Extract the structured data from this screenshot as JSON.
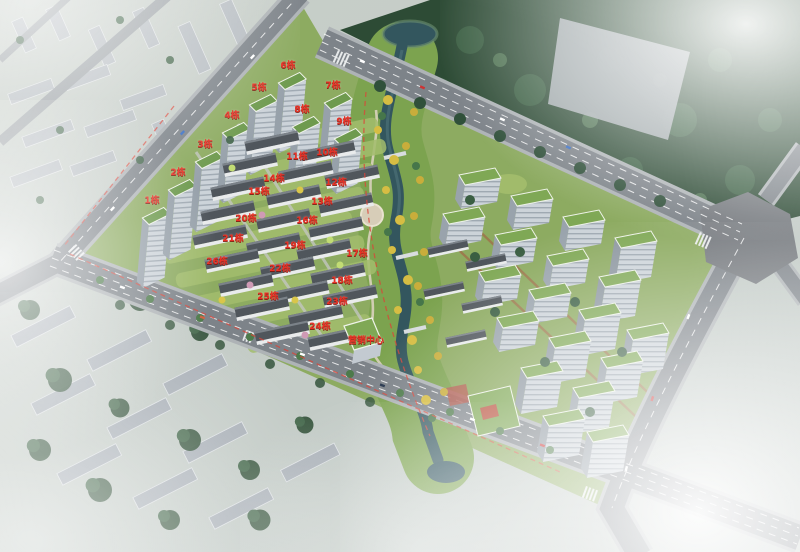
{
  "scene": {
    "kind": "aerial-masterplan-rendering",
    "marketing_center_label": "营销中心"
  },
  "labels": {
    "buildings": [
      {
        "id": "1",
        "text": "1栋",
        "x": 152,
        "y": 200,
        "kind": "tower"
      },
      {
        "id": "2",
        "text": "2栋",
        "x": 178,
        "y": 172,
        "kind": "tower"
      },
      {
        "id": "3",
        "text": "3栋",
        "x": 205,
        "y": 144,
        "kind": "tower"
      },
      {
        "id": "4",
        "text": "4栋",
        "x": 232,
        "y": 115,
        "kind": "tower"
      },
      {
        "id": "5",
        "text": "5栋",
        "x": 259,
        "y": 87,
        "kind": "tower"
      },
      {
        "id": "6",
        "text": "6栋",
        "x": 288,
        "y": 65,
        "kind": "tower"
      },
      {
        "id": "7",
        "text": "7栋",
        "x": 333,
        "y": 85,
        "kind": "tower"
      },
      {
        "id": "8",
        "text": "8栋",
        "x": 302,
        "y": 109,
        "kind": "tower"
      },
      {
        "id": "9",
        "text": "9栋",
        "x": 344,
        "y": 121,
        "kind": "tower"
      },
      {
        "id": "10",
        "text": "10栋",
        "x": 327,
        "y": 152,
        "kind": "villa"
      },
      {
        "id": "11",
        "text": "11栋",
        "x": 297,
        "y": 156,
        "kind": "villa"
      },
      {
        "id": "12",
        "text": "12栋",
        "x": 336,
        "y": 182,
        "kind": "villa"
      },
      {
        "id": "13",
        "text": "13栋",
        "x": 322,
        "y": 201,
        "kind": "villa"
      },
      {
        "id": "14",
        "text": "14栋",
        "x": 274,
        "y": 178,
        "kind": "villa"
      },
      {
        "id": "15",
        "text": "15栋",
        "x": 259,
        "y": 191,
        "kind": "villa"
      },
      {
        "id": "16",
        "text": "16栋",
        "x": 307,
        "y": 220,
        "kind": "villa"
      },
      {
        "id": "17",
        "text": "17栋",
        "x": 357,
        "y": 253,
        "kind": "villa"
      },
      {
        "id": "18",
        "text": "18栋",
        "x": 342,
        "y": 280,
        "kind": "villa"
      },
      {
        "id": "19",
        "text": "19栋",
        "x": 295,
        "y": 245,
        "kind": "villa"
      },
      {
        "id": "20",
        "text": "20栋",
        "x": 246,
        "y": 218,
        "kind": "villa"
      },
      {
        "id": "21",
        "text": "21栋",
        "x": 233,
        "y": 238,
        "kind": "villa"
      },
      {
        "id": "22",
        "text": "22栋",
        "x": 280,
        "y": 268,
        "kind": "villa"
      },
      {
        "id": "23",
        "text": "23栋",
        "x": 337,
        "y": 301,
        "kind": "villa"
      },
      {
        "id": "24",
        "text": "24栋",
        "x": 320,
        "y": 326,
        "kind": "villa"
      },
      {
        "id": "25",
        "text": "25栋",
        "x": 268,
        "y": 296,
        "kind": "villa"
      },
      {
        "id": "26",
        "text": "26栋",
        "x": 217,
        "y": 261,
        "kind": "villa"
      }
    ],
    "special": [
      {
        "id": "marketing-center",
        "text": "营销中心",
        "x": 366,
        "y": 340,
        "kind": "special"
      }
    ]
  },
  "palette": {
    "label_red": "#ea3125",
    "river_teal": "#33565e",
    "green_roof": "#7fa855",
    "villa_roof_gray": "#50565c",
    "road_gray": "#7d8389",
    "forest_green": "#2d4b35",
    "lawn_green": "#8dab61",
    "autumn_yellow": "#d6bd43",
    "haze_white": "#ffffff"
  }
}
